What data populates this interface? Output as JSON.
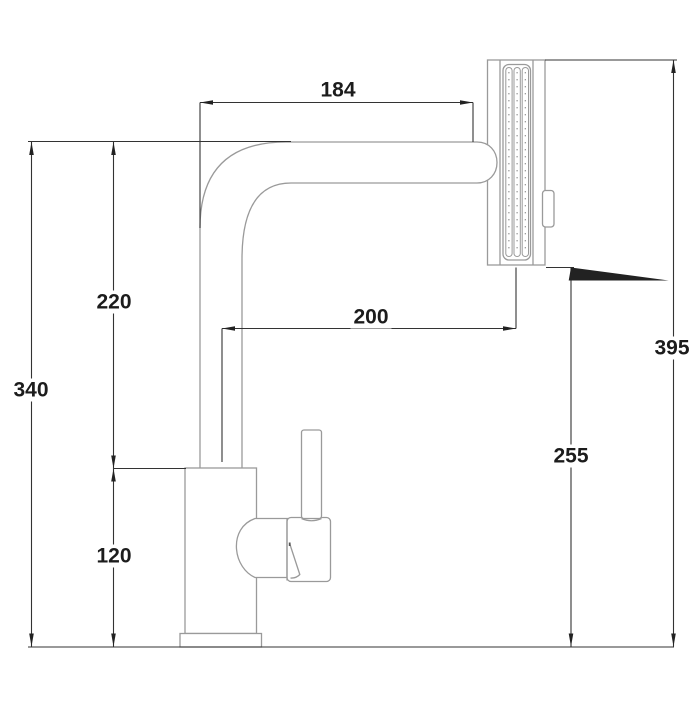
{
  "figure": {
    "type": "technical-dimension-drawing",
    "subject": "Kitchen faucet with pull-out spray head, side elevation",
    "background_color": "#ffffff",
    "outline_color": "#9a9a9a",
    "dimension_line_color": "#333333",
    "arrow_color": "#222222",
    "text_color": "#1c1c1c"
  },
  "dimensions": {
    "d184": {
      "label": "184",
      "value": 184,
      "orientation": "horizontal"
    },
    "d200": {
      "label": "200",
      "value": 200,
      "orientation": "horizontal"
    },
    "d220": {
      "label": "220",
      "value": 220,
      "orientation": "vertical"
    },
    "d120": {
      "label": "120",
      "value": 120,
      "orientation": "vertical"
    },
    "d340": {
      "label": "340",
      "value": 340,
      "orientation": "vertical"
    },
    "d395": {
      "label": "395",
      "value": 395,
      "orientation": "vertical"
    },
    "d255": {
      "label": "255",
      "value": 255,
      "orientation": "vertical"
    }
  }
}
